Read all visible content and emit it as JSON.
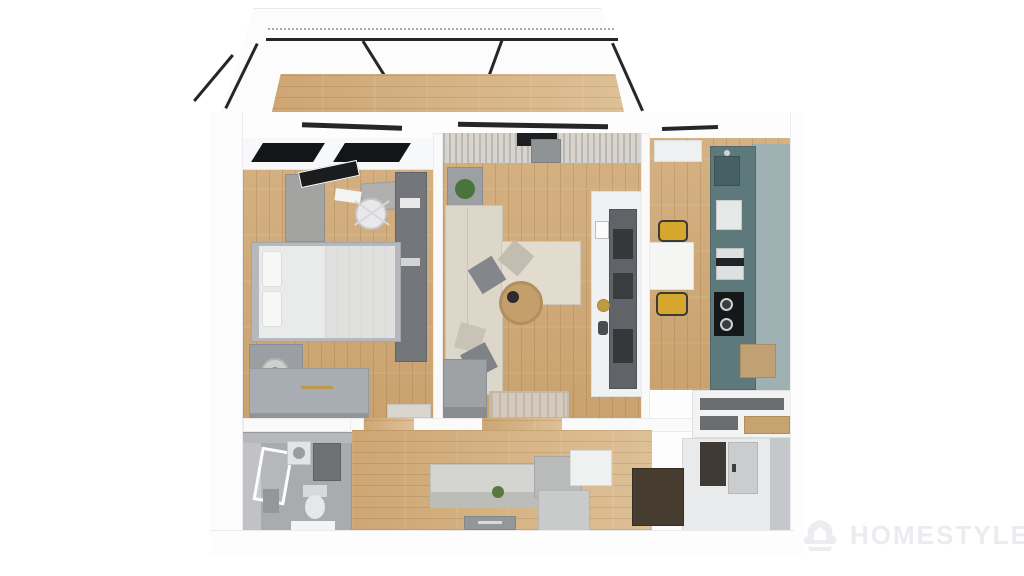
{
  "watermark": {
    "brand": "HOMESTYLER",
    "logo_icon": "homestyler-logo"
  },
  "palette": {
    "background": "#ffffff",
    "wall_white": "#fafafb",
    "wood_floor_light": "#d5b183",
    "wood_floor_dark": "#c9a26e",
    "window_frame_black": "#1b1c1e",
    "kitchen_cabinet_teal_dark": "#5d797c",
    "kitchen_cabinet_teal_light": "#9fb1b2",
    "sofa_cream": "#ddd7ca",
    "furniture_gray": "#9b9ea2",
    "bathroom_gray": "#a9acaf",
    "chair_yellow": "#d5a72e",
    "plant_green": "#49743c",
    "accent_gold": "#bf9c42",
    "doormat_brown": "#463c30",
    "watermark_gray": "#ebebf0"
  },
  "scene": {
    "type": "3d-floorplan-top-down-render",
    "rooms": [
      {
        "name": "balcony",
        "items": [
          "glass-walls-black-frame",
          "wood-floor"
        ]
      },
      {
        "name": "bedroom",
        "items": [
          "skylight-window",
          "desk",
          "monitor",
          "office-chair",
          "wardrobe",
          "double-bed",
          "pillows",
          "nightstand-lamp",
          "dresser",
          "door-rug"
        ]
      },
      {
        "name": "living-room",
        "items": [
          "curtains",
          "window",
          "sideboard",
          "potted-plant",
          "l-shaped-sofa",
          "throw-pillows",
          "ottoman",
          "round-coffee-table",
          "media-shelf-wall",
          "picture-frame",
          "gold-clock",
          "rug"
        ]
      },
      {
        "name": "kitchen",
        "items": [
          "skylight-window",
          "teal-counter",
          "sink",
          "fridge",
          "oven",
          "cooktop",
          "marble-dining-table",
          "yellow-chair",
          "yellow-chair"
        ]
      },
      {
        "name": "bathroom",
        "items": [
          "shower",
          "washer",
          "vanity-counter",
          "toilet",
          "cabinet"
        ]
      },
      {
        "name": "hallway",
        "items": [
          "bench",
          "storage-boxes",
          "doormat",
          "plant-decor"
        ]
      },
      {
        "name": "entry",
        "items": [
          "shelf-unit",
          "wood-cubby",
          "entry-door",
          "dark-doormat"
        ]
      }
    ]
  }
}
